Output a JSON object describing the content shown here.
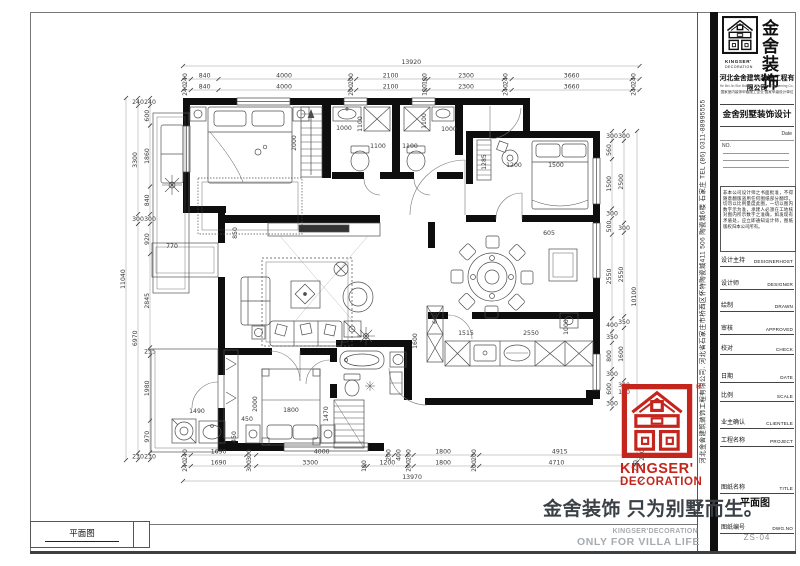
{
  "sheet": {
    "bottom_label": "平面图",
    "slogan": "金舍装饰 只为别墅而生。",
    "slogan_en_small": "KINGSER'DECORATION",
    "slogan_en_large": "ONLY FOR VILLA LIFE",
    "side_text": "河北金舍建筑装饰工程有限公司. 河北省石家庄市桥西区怀特陶瓷城411 506 陶瓷城6楼 石家庄 TEL (86) 0311-88995555",
    "registered_mark": "®"
  },
  "title_block": {
    "brand_cn_1": "金舍",
    "brand_cn_2": "装饰",
    "brand_en_1": "KINGSER'",
    "brand_en_2": "DECORATION",
    "company": "河北金舍建筑装饰工程有限公司",
    "company_en": "He Bei Jin She Building Decoration Engineering Co., Ltd",
    "qualification": "国家室内装饰甲级施工企业 国家甲级设计单位",
    "project_title": "金舍别墅装饰设计",
    "date_label": "Date",
    "no_label": "NO.",
    "disclaimer": "非本公司设计师之书面批准，不得随意翻版盗用任何图纸部分翻印。切勿以比例量度此图，一切以图内数字示为准，承建人必须在工地核对图内所示数字之准确，如发现有矛盾处，应立即通知设计师，图纸版权归本公司所有。",
    "rows": [
      {
        "cn": "设计主持",
        "en": "DESIGNERHOST"
      },
      {
        "cn": "设计师",
        "en": "DESIGNER"
      },
      {
        "cn": "绘制",
        "en": "DRAWN"
      },
      {
        "cn": "审核",
        "en": "APPROVED"
      },
      {
        "cn": "校对",
        "en": "CHECK"
      },
      {
        "cn": "日期",
        "en": "DATE"
      },
      {
        "cn": "比例",
        "en": "SCALE"
      },
      {
        "cn": "业主确认",
        "en": "CLIENTELE"
      },
      {
        "cn": "工程名称",
        "en": "PROJECT"
      },
      {
        "cn": "图纸名称",
        "en": "TITLE"
      },
      {
        "cn": "图纸编号",
        "en": "DWG.NO"
      }
    ],
    "drawing_title": "平面图",
    "drawing_no": "ZS-04",
    "accent_red": "#c4261d"
  },
  "floorplan": {
    "scale_px_per_mm": 0.0328,
    "dim_chains": [
      {
        "name": "top-total",
        "orient": "h",
        "x": 183,
        "y": 66,
        "values": [
          13920
        ],
        "total": true
      },
      {
        "name": "top-row-1",
        "orient": "h",
        "x": 183,
        "y": 79,
        "values": [
          240,
          840,
          4000,
          200,
          2100,
          100,
          2300,
          240,
          3660,
          240
        ]
      },
      {
        "name": "top-row-2",
        "orient": "h",
        "x": 183,
        "y": 90,
        "values": [
          240,
          840,
          4000,
          200,
          2100,
          100,
          2300,
          240,
          3660,
          240
        ]
      },
      {
        "name": "bottom-row-1",
        "orient": "h",
        "x": 183,
        "y": 455,
        "values": [
          240,
          1690,
          300,
          4000,
          200,
          400,
          200,
          1800,
          200,
          4915,
          230
        ]
      },
      {
        "name": "bottom-row-2",
        "orient": "h",
        "x": 183,
        "y": 466,
        "values": [
          240,
          1690,
          300,
          3300,
          100,
          1200,
          200,
          1800,
          200,
          4710,
          230
        ]
      },
      {
        "name": "bottom-total",
        "orient": "h",
        "x": 183,
        "y": 481,
        "values": [
          13970
        ],
        "total": true
      },
      {
        "name": "left-total",
        "orient": "v",
        "x": 126,
        "y": 98,
        "values": [
          11040
        ],
        "total": true
      },
      {
        "name": "left-col-outer",
        "orient": "v",
        "x": 138,
        "y": 98,
        "values": [
          240,
          3300,
          300,
          6970,
          230
        ]
      },
      {
        "name": "left-col-inner",
        "orient": "v",
        "x": 150,
        "y": 98,
        "values": [
          240,
          600,
          1860,
          840,
          300,
          920,
          2845,
          255,
          1980,
          970,
          230
        ]
      },
      {
        "name": "right-col-inner",
        "orient": "v",
        "x": 612,
        "y": 131,
        "values": [
          300,
          560,
          1500,
          300,
          500,
          2550,
          400,
          350,
          800,
          300,
          600,
          300
        ]
      },
      {
        "name": "right-col-outer",
        "orient": "v",
        "x": 624,
        "y": 131,
        "values": [
          300,
          2500,
          300,
          2550,
          350,
          1600,
          300,
          100
        ]
      },
      {
        "name": "right-total",
        "orient": "v",
        "x": 637,
        "y": 131,
        "values": [
          10100
        ],
        "total": true
      }
    ],
    "free_labels": [
      {
        "t": "2000",
        "x": 296,
        "y": 143,
        "r": -90
      },
      {
        "t": "1000",
        "x": 344,
        "y": 130
      },
      {
        "t": "1100",
        "x": 362,
        "y": 124,
        "r": -90
      },
      {
        "t": "1100",
        "x": 378,
        "y": 148
      },
      {
        "t": "1100",
        "x": 410,
        "y": 148
      },
      {
        "t": "1100",
        "x": 426,
        "y": 121,
        "r": -90
      },
      {
        "t": "1000",
        "x": 449,
        "y": 131
      },
      {
        "t": "1285",
        "x": 486,
        "y": 162,
        "r": -90
      },
      {
        "t": "1200",
        "x": 514,
        "y": 167
      },
      {
        "t": "1500",
        "x": 556,
        "y": 167
      },
      {
        "t": "605",
        "x": 549,
        "y": 235
      },
      {
        "t": "850",
        "x": 237,
        "y": 233,
        "r": -90
      },
      {
        "t": "770",
        "x": 172,
        "y": 248
      },
      {
        "t": "1515",
        "x": 466,
        "y": 335
      },
      {
        "t": "2550",
        "x": 531,
        "y": 335
      },
      {
        "t": "1000",
        "x": 568,
        "y": 327,
        "r": -90
      },
      {
        "t": "1600",
        "x": 417,
        "y": 341,
        "r": -90
      },
      {
        "t": "600",
        "x": 437,
        "y": 318,
        "r": -90
      },
      {
        "t": "1490",
        "x": 197,
        "y": 413
      },
      {
        "t": "450",
        "x": 247,
        "y": 421
      },
      {
        "t": "450",
        "x": 236,
        "y": 437,
        "r": -90
      },
      {
        "t": "2000",
        "x": 257,
        "y": 404,
        "r": -90
      },
      {
        "t": "1800",
        "x": 291,
        "y": 412
      },
      {
        "t": "1470",
        "x": 328,
        "y": 414,
        "r": -90
      }
    ]
  }
}
